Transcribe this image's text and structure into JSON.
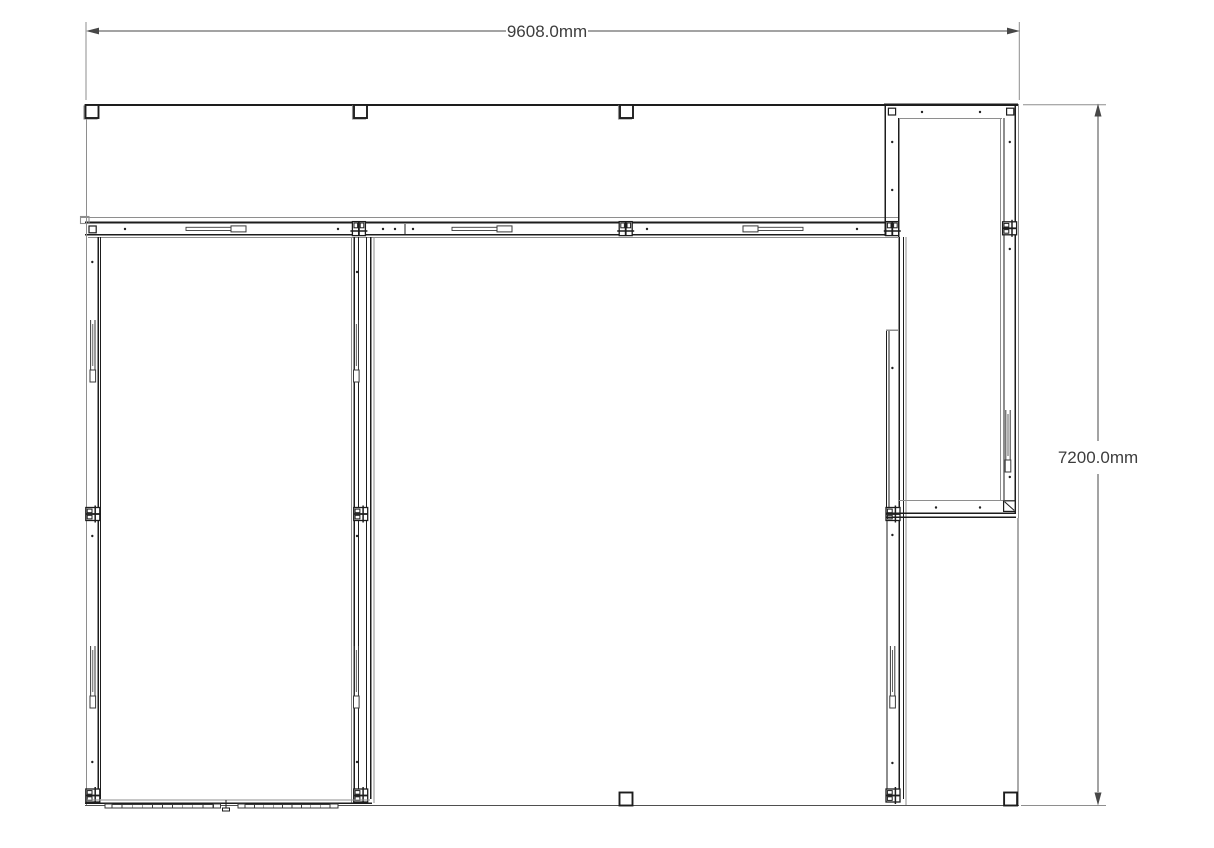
{
  "drawing": {
    "kind": "cad-floor-plan-top-view",
    "dimension_width": {
      "label": "9608.0mm",
      "value_mm": 9608.0
    },
    "dimension_height": {
      "label": "7200.0mm",
      "value_mm": 7200.0
    },
    "colors": {
      "background": "#ffffff",
      "wall_line": "#1d1d1d",
      "secondary_line": "#8e8e8e",
      "dimension_line": "#474747",
      "dimension_text": "#3d3d3d"
    },
    "features": {
      "top_edge_posts": 3,
      "bottom_edge_posts": 2,
      "rooms": [
        "left-room",
        "center-room",
        "right-annex"
      ]
    }
  }
}
